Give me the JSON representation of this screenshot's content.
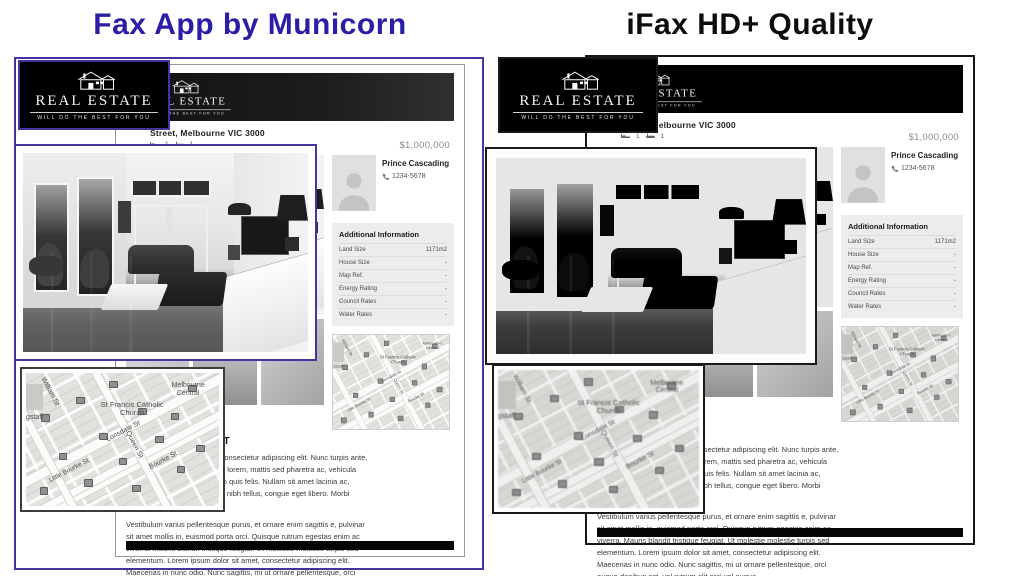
{
  "comparison": {
    "left_title": "Fax App by Municorn",
    "right_title": "iFax HD+ Quality",
    "left_accent_color": "#2a1ea6",
    "right_accent_color": "#0d0d0d"
  },
  "document": {
    "logo": {
      "name": "REAL ESTATE",
      "tagline": "WILL DO THE BEST FOR YOU"
    },
    "listing": {
      "address": "Street, Melbourne VIC 3000",
      "price": "$1,000,000",
      "beds": "1",
      "baths": "1"
    },
    "agent": {
      "name": "Prince Cascading",
      "phone": "1234-5678"
    },
    "additional_info": {
      "title": "Additional Information",
      "rows": [
        {
          "label": "Land Size",
          "value": "1171m2"
        },
        {
          "label": "House Size",
          "value": "-"
        },
        {
          "label": "Map Ref.",
          "value": "-"
        },
        {
          "label": "Energy Rating",
          "value": "-"
        },
        {
          "label": "Council Rates",
          "value": "-"
        },
        {
          "label": "Water Rates",
          "value": "-"
        }
      ]
    },
    "description": {
      "heading": "ADVERTISEMENT",
      "paragraph1": "Lorem ipsum dolor sit amet, consectetur adipiscing elit. Nunc turpis ante, fermentum ac sagittis in, justo lorem, mattis sed pharetra ac, vehicula neque at gravida vel, interdum quis felis. Nullam sit amet lacinia ac, sollicitudin eget nisl. Praesent nibh tellus, congue eget libero. Morbi sodales tincidunt turpis et",
      "paragraph2": "Vestibulum varius pellentesque purus, et ornare enim sagittis e, pulvinar sit amet mollis in, euismod porta orci. Quisque rutrum egestas enim ac viverra. Mauris blandit tristique feugiat. Ut molestie molestie turpis sed elementum. Lorem ipsum dolor sit amet, consectetur adipiscing elit. Maecenas in nunc odio. Nunc sagittis, mi ut ornare pellentesque, orci augue dapibus est, vel rutrum elit orci vel augue."
    }
  },
  "map": {
    "labels": {
      "station": "Melbourne Central",
      "church": "St Francis Catholic Church",
      "lonsdale": "Lonsdale St",
      "queen": "Queen St",
      "bourke": "Bourke St",
      "little_bourke": "Little Bourke St",
      "william": "William St",
      "flagstaff": "gstaff"
    }
  }
}
